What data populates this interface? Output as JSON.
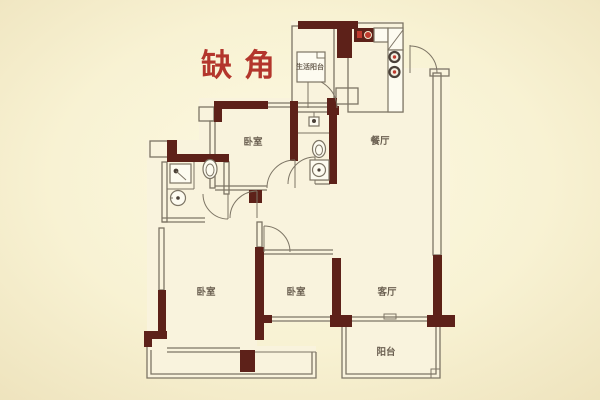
{
  "annotation": {
    "text": "缺角"
  },
  "rooms": [
    {
      "id": "utility-balcony",
      "label": "生活阳台"
    },
    {
      "id": "dining-room",
      "label": "餐厅"
    },
    {
      "id": "bedroom-top",
      "label": "卧室"
    },
    {
      "id": "bedroom-left",
      "label": "卧室"
    },
    {
      "id": "bedroom-middle",
      "label": "卧室"
    },
    {
      "id": "living-room",
      "label": "客厅"
    },
    {
      "id": "balcony",
      "label": "阳台"
    }
  ],
  "colors": {
    "bg-outer": "#eee3bd",
    "bg-inner": "#fcf9e2",
    "room": "#f9f3dd",
    "wall": "#5d2119",
    "line": "#7d7565",
    "label": "#6b6051",
    "accent": "#b3362c",
    "accent2": "#c03a2e",
    "fixture": "#fdfbf0"
  }
}
